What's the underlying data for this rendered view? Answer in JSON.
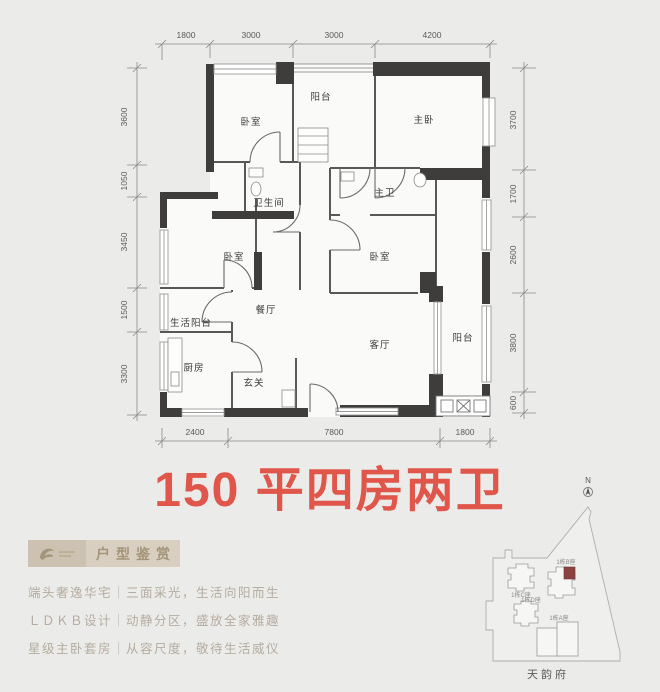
{
  "title": {
    "text": "150 平四房两卫",
    "color": "#e0564a"
  },
  "floorplan": {
    "wall_color": "#3e3d3b",
    "rooms": [
      "卧室",
      "阳台",
      "主卧",
      "卫生间",
      "主卫",
      "卧室",
      "卧室",
      "生活阳台",
      "餐厅",
      "客厅",
      "阳台",
      "厨房",
      "玄关"
    ],
    "dims_top": [
      "1800",
      "3000",
      "3000",
      "4200"
    ],
    "dims_left": [
      "3600",
      "1050",
      "3450",
      "1500",
      "3300"
    ],
    "dims_right": [
      "3700",
      "1700",
      "2600",
      "3800",
      "600"
    ],
    "dims_bottom": [
      "2400",
      "7800",
      "1800"
    ]
  },
  "highlights": {
    "badge": "户型鉴赏",
    "features": [
      "端头奢逸华宅｜三面采光，生活向阳而生",
      "ＬＤＫＢ设计｜动静分区，盛放全家雅趣",
      "星级主卧套房｜从容尺度，敬待生活威仪"
    ]
  },
  "sitemap": {
    "compass": "N",
    "buildings": [
      "1栋C座",
      "1栋B座",
      "1栋D座",
      "1栋A座"
    ],
    "project": "天韵府",
    "highlight_color": "#8d4242"
  }
}
